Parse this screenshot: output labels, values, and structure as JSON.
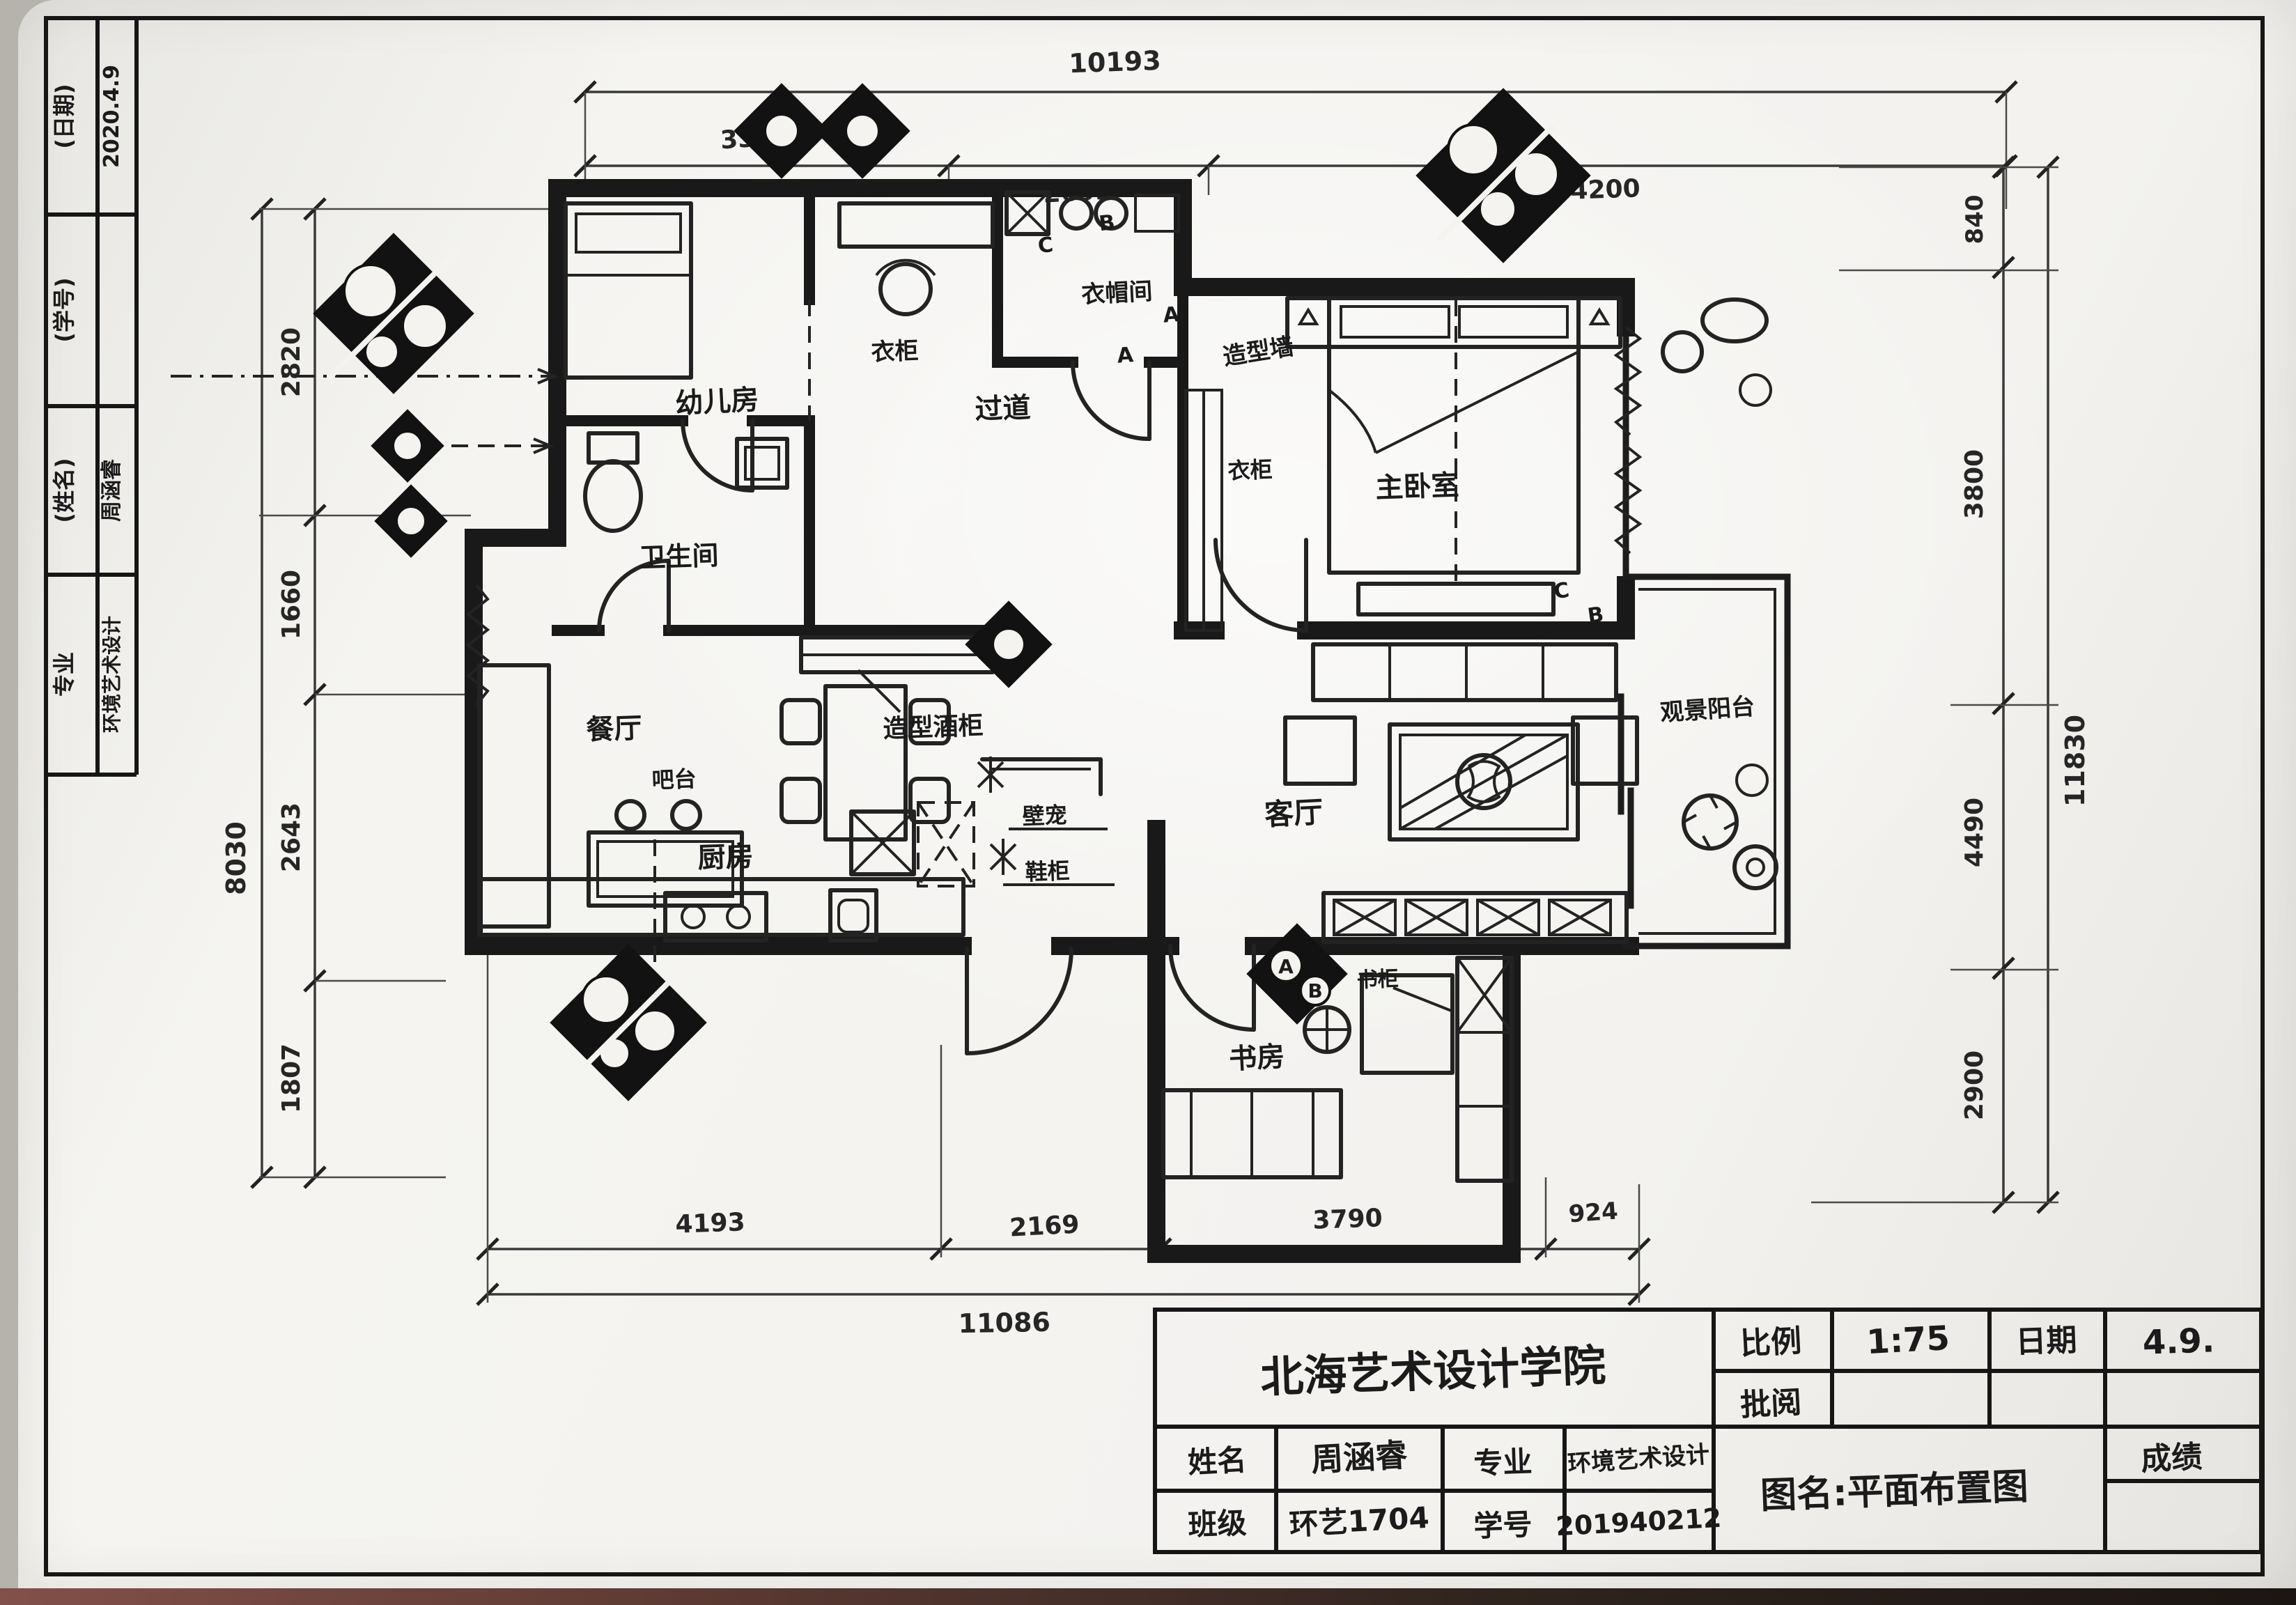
{
  "scene": {
    "background": "#b6b2ac",
    "paper": "#f4f3f0",
    "ink": "#1b1b1b",
    "table_edge": "#5c3a33"
  },
  "left_strip": {
    "rows": [
      {
        "label": "(日期)",
        "value": "2020.4.9"
      },
      {
        "label": "(学号)",
        "value": ""
      },
      {
        "label": "(姓名)",
        "value": "周涵睿"
      },
      {
        "label": "专业",
        "value": "环境艺术设计"
      }
    ]
  },
  "rooms": {
    "nursery": "幼儿房",
    "nursery_wardrobe": "衣柜",
    "cloakroom": "衣帽间",
    "hallway": "过道",
    "feature_wall": "造型墙",
    "master_bedroom": "主卧室",
    "master_wardrobe": "衣柜",
    "bathroom": "卫生间",
    "dining": "餐厅",
    "wine_cabinet": "造型酒柜",
    "bar": "吧台",
    "living": "客厅",
    "niche": "壁宠",
    "shoe_cabinet": "鞋柜",
    "kitchen": "厨房",
    "study": "书房",
    "bookcase": "书柜",
    "balcony": "观景阳台"
  },
  "door_tags": {
    "c_top": "C",
    "b_top": "B",
    "a_hall": "A",
    "a_master": "A",
    "c_balcony": "C",
    "b_balcony": "B",
    "a_study": "A",
    "b_study": "B"
  },
  "dimensions": {
    "top": {
      "overall": "10193",
      "seg1": "3300",
      "seg2": "2693",
      "seg3": "4200"
    },
    "bottom": {
      "overall": "11086",
      "seg1": "4193",
      "seg2": "2169",
      "seg3": "3790",
      "seg4": "924"
    },
    "left": {
      "overall": "8030",
      "seg1": "2820",
      "seg2": "1660",
      "seg3": "2643",
      "seg4": "1807"
    },
    "right": {
      "overall": "11830",
      "seg1": "840",
      "seg2": "3800",
      "seg3": "4490",
      "seg4": "2900"
    }
  },
  "title_block": {
    "school": "北海艺术设计学院",
    "scale_label": "比例",
    "scale_value": "1:75",
    "date_label": "日期",
    "date_value": "4.9.",
    "review_label": "批阅",
    "name_label": "姓名",
    "name_value": "周涵睿",
    "major_label": "专业",
    "major_value": "环境艺术设计",
    "class_label": "班级",
    "class_value": "环艺1704",
    "student_id_label": "学号",
    "student_id_value": "201940212",
    "drawing_name": "图名:平面布置图",
    "grade_label": "成绩"
  }
}
